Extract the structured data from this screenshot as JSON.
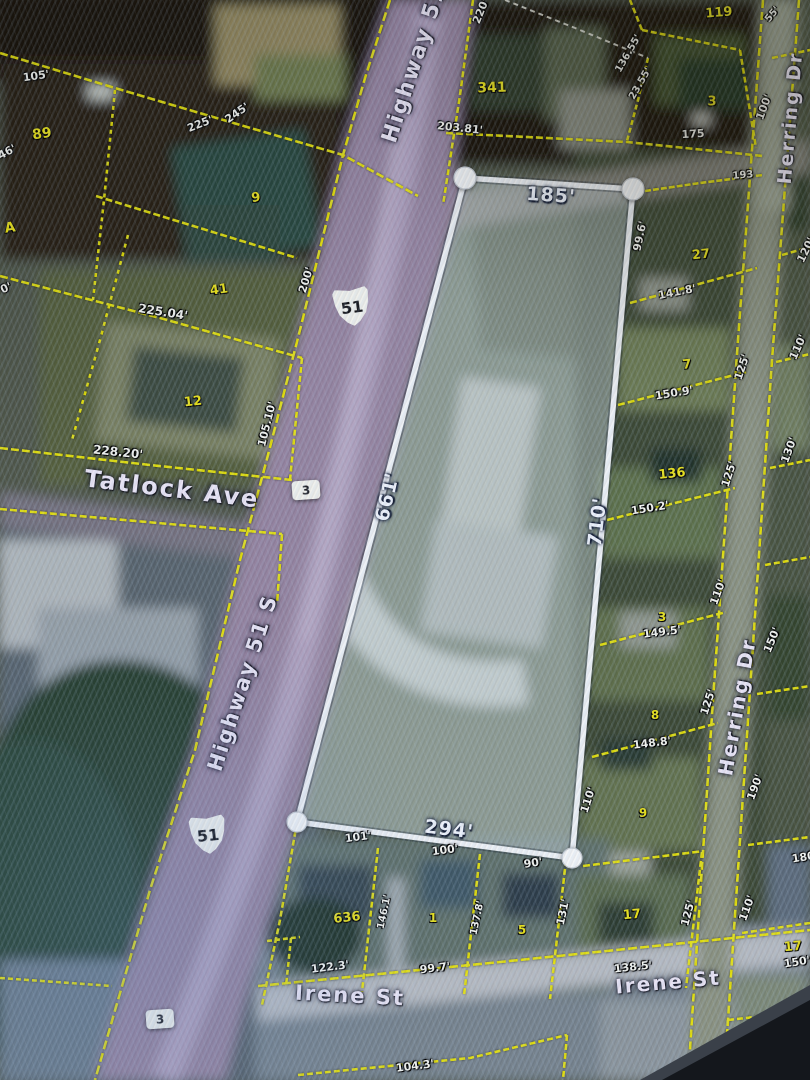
{
  "map": {
    "colors": {
      "parcel_line": "#e6e20a",
      "selected_parcel_outline": "#eef1f5",
      "dimension_text": "#f3f4ef",
      "parcel_number_text": "#e8e11a",
      "street_text": "#e9e4f4",
      "highway_fill": "#9786a6"
    },
    "selected_parcel": {
      "labels": [
        {
          "t": "185'",
          "x": 551,
          "y": 196,
          "r": 4
        },
        {
          "t": "661'",
          "x": 388,
          "y": 497,
          "r": -77
        },
        {
          "t": "710'",
          "x": 598,
          "y": 522,
          "r": -83
        },
        {
          "t": "294'",
          "x": 449,
          "y": 830,
          "r": 7
        }
      ]
    },
    "streets": [
      {
        "t": "Highway 51",
        "x": 415,
        "y": 64,
        "r": -72,
        "s": 22
      },
      {
        "t": "Highway 51 S",
        "x": 243,
        "y": 683,
        "r": -72,
        "s": 21
      },
      {
        "t": "Herring Dr",
        "x": 791,
        "y": 118,
        "r": -85,
        "s": 19
      },
      {
        "t": "Herring Dr",
        "x": 737,
        "y": 707,
        "r": -80,
        "s": 20
      },
      {
        "t": "Tatlock Ave",
        "x": 172,
        "y": 489,
        "r": 7,
        "s": 24
      },
      {
        "t": "Irene St",
        "x": 350,
        "y": 996,
        "r": 3,
        "s": 21
      },
      {
        "t": "Irene St",
        "x": 668,
        "y": 982,
        "r": -5,
        "s": 20
      }
    ],
    "route_shields": [
      {
        "t": "51",
        "x": 352,
        "y": 307,
        "r": -8,
        "k": "us"
      },
      {
        "t": "51",
        "x": 208,
        "y": 835,
        "r": -6,
        "k": "us"
      },
      {
        "t": "3",
        "x": 306,
        "y": 490,
        "r": -4,
        "k": "ms"
      },
      {
        "t": "3",
        "x": 160,
        "y": 1019,
        "r": -4,
        "k": "ms"
      }
    ],
    "parcel_numbers": [
      {
        "t": "89",
        "x": 42,
        "y": 134,
        "r": -8,
        "s": 14
      },
      {
        "t": "A",
        "x": 10,
        "y": 228,
        "r": -8,
        "s": 14
      },
      {
        "t": "9",
        "x": 256,
        "y": 198,
        "r": -8
      },
      {
        "t": "41",
        "x": 219,
        "y": 290,
        "r": -8
      },
      {
        "t": "12",
        "x": 193,
        "y": 402,
        "r": -6
      },
      {
        "t": "341",
        "x": 492,
        "y": 88,
        "r": -2,
        "s": 14
      },
      {
        "t": "119",
        "x": 719,
        "y": 13,
        "r": -5,
        "s": 13
      },
      {
        "t": "3",
        "x": 712,
        "y": 102,
        "r": 0
      },
      {
        "t": "27",
        "x": 701,
        "y": 255,
        "r": -6
      },
      {
        "t": "7",
        "x": 687,
        "y": 365,
        "r": -5
      },
      {
        "t": "136",
        "x": 672,
        "y": 474,
        "r": -6
      },
      {
        "t": "3",
        "x": 662,
        "y": 617,
        "r": 0,
        "s": 12
      },
      {
        "t": "8",
        "x": 655,
        "y": 715,
        "r": 0,
        "s": 12
      },
      {
        "t": "9",
        "x": 643,
        "y": 813,
        "r": 0,
        "s": 12
      },
      {
        "t": "636",
        "x": 347,
        "y": 918,
        "r": -6
      },
      {
        "t": "1",
        "x": 433,
        "y": 918,
        "r": 0,
        "s": 12
      },
      {
        "t": "5",
        "x": 522,
        "y": 930,
        "r": 0,
        "s": 12
      },
      {
        "t": "17",
        "x": 632,
        "y": 915,
        "r": -5
      },
      {
        "t": "17",
        "x": 793,
        "y": 947,
        "r": -5
      }
    ],
    "dimensions": [
      {
        "t": "105'",
        "x": 36,
        "y": 76,
        "r": -8
      },
      {
        "t": "225'",
        "x": 200,
        "y": 124,
        "r": -22
      },
      {
        "t": "245'",
        "x": 237,
        "y": 113,
        "r": -35
      },
      {
        "t": "46'",
        "x": 7,
        "y": 152,
        "r": -28
      },
      {
        "t": "0'",
        "x": 6,
        "y": 288,
        "r": -24
      },
      {
        "t": "225.04'",
        "x": 163,
        "y": 312,
        "r": 9,
        "s": 12
      },
      {
        "t": "228.20'",
        "x": 118,
        "y": 452,
        "r": 6,
        "s": 12
      },
      {
        "t": "105.10'",
        "x": 267,
        "y": 424,
        "r": -76
      },
      {
        "t": "200'",
        "x": 306,
        "y": 280,
        "r": -73
      },
      {
        "t": "220'",
        "x": 481,
        "y": 11,
        "r": -68
      },
      {
        "t": "203.81'",
        "x": 460,
        "y": 128,
        "r": 6
      },
      {
        "t": "136.55'",
        "x": 629,
        "y": 54,
        "r": -60,
        "s": 10
      },
      {
        "t": "23.55'",
        "x": 641,
        "y": 84,
        "r": -60,
        "s": 10
      },
      {
        "t": "175",
        "x": 693,
        "y": 134,
        "r": -3
      },
      {
        "t": "100'",
        "x": 764,
        "y": 107,
        "r": -70
      },
      {
        "t": "55'",
        "x": 773,
        "y": 15,
        "r": -50,
        "s": 10
      },
      {
        "t": "193",
        "x": 743,
        "y": 176,
        "r": -5,
        "s": 10
      },
      {
        "t": "99.6'",
        "x": 640,
        "y": 236,
        "r": -78
      },
      {
        "t": "141.8'",
        "x": 677,
        "y": 292,
        "r": -11
      },
      {
        "t": "120'",
        "x": 806,
        "y": 250,
        "r": -64
      },
      {
        "t": "125'",
        "x": 742,
        "y": 367,
        "r": -72
      },
      {
        "t": "110'",
        "x": 798,
        "y": 347,
        "r": -66
      },
      {
        "t": "150.9'",
        "x": 674,
        "y": 393,
        "r": -9
      },
      {
        "t": "150.2'",
        "x": 650,
        "y": 508,
        "r": -9
      },
      {
        "t": "125'",
        "x": 729,
        "y": 474,
        "r": -72
      },
      {
        "t": "130'",
        "x": 789,
        "y": 450,
        "r": -70
      },
      {
        "t": "110'",
        "x": 718,
        "y": 592,
        "r": -70
      },
      {
        "t": "149.5'",
        "x": 662,
        "y": 632,
        "r": -7
      },
      {
        "t": "150'",
        "x": 772,
        "y": 640,
        "r": -68
      },
      {
        "t": "125'",
        "x": 708,
        "y": 702,
        "r": -72
      },
      {
        "t": "148.8'",
        "x": 652,
        "y": 743,
        "r": -7
      },
      {
        "t": "190'",
        "x": 755,
        "y": 787,
        "r": -70
      },
      {
        "t": "110'",
        "x": 588,
        "y": 800,
        "r": -72
      },
      {
        "t": "101'",
        "x": 358,
        "y": 837,
        "r": -7
      },
      {
        "t": "100'",
        "x": 445,
        "y": 850,
        "r": -7
      },
      {
        "t": "90'",
        "x": 533,
        "y": 863,
        "r": -9
      },
      {
        "t": "146.1'",
        "x": 385,
        "y": 912,
        "r": -78,
        "s": 10
      },
      {
        "t": "137.8'",
        "x": 478,
        "y": 918,
        "r": -78,
        "s": 10
      },
      {
        "t": "131'",
        "x": 563,
        "y": 912,
        "r": -78
      },
      {
        "t": "125'",
        "x": 688,
        "y": 913,
        "r": -75
      },
      {
        "t": "110'",
        "x": 747,
        "y": 908,
        "r": -70
      },
      {
        "t": "122.3'",
        "x": 330,
        "y": 967,
        "r": -7
      },
      {
        "t": "99.7'",
        "x": 435,
        "y": 968,
        "r": -7
      },
      {
        "t": "138.5'",
        "x": 633,
        "y": 967,
        "r": -6
      },
      {
        "t": "180'",
        "x": 805,
        "y": 857,
        "r": -9
      },
      {
        "t": "150'",
        "x": 797,
        "y": 962,
        "r": -9
      },
      {
        "t": "150'",
        "x": 787,
        "y": 1022,
        "r": -9
      },
      {
        "t": "104.3'",
        "x": 415,
        "y": 1066,
        "r": -7
      }
    ]
  }
}
